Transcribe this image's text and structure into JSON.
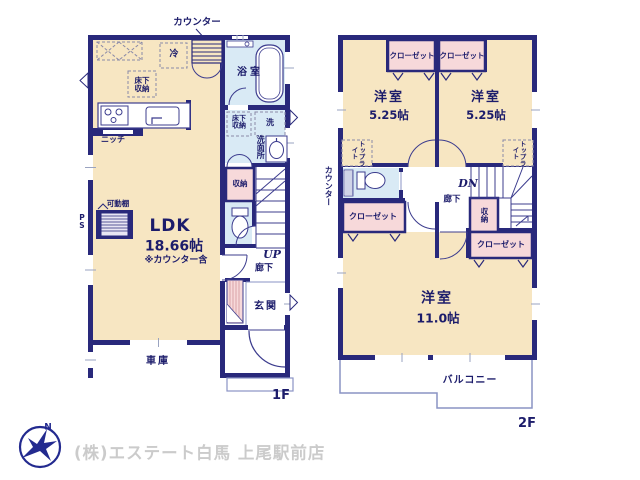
{
  "colors": {
    "wall": "#29297b",
    "room_beige": "#f7e6c2",
    "room_blue": "#d9eaf5",
    "room_pink": "#f7d9da",
    "thin_outline": "#8a93c4",
    "text": "#1c1c6b",
    "company_text": "#cbcbcb"
  },
  "floor1": {
    "label": "1F",
    "counter_label": "カウンター",
    "ldk": {
      "name": "LDK",
      "size": "18.66帖",
      "note": "※カウンター含"
    },
    "kitchen": {
      "fridge": "冷",
      "underfloor_storage": "床下収納",
      "niche": "ニッチ"
    },
    "bathroom": {
      "name": "浴室"
    },
    "washroom": {
      "name": "洗面所",
      "underfloor_storage": "床下収納",
      "laundry": "洗"
    },
    "storage": "収納",
    "movable_shelf": "可動棚",
    "pipe_space": "PS",
    "stairs": "UP",
    "hallway": "廊下",
    "entrance": "玄関",
    "garage": "車庫"
  },
  "floor2": {
    "label": "2F",
    "counter_label": "カウンター",
    "bedroom_left": {
      "name": "洋室",
      "size": "5.25帖",
      "closet": "クローゼット",
      "skylight": "トップライト"
    },
    "bedroom_right": {
      "name": "洋室",
      "size": "5.25帖",
      "closet": "クローゼット",
      "skylight": "トップライト"
    },
    "bedroom_main": {
      "name": "洋室",
      "size": "11.0帖",
      "closet_left": "クローゼット",
      "closet_right": "クローゼット",
      "storage": "収納"
    },
    "hallway": "廊下",
    "stairs": "DN",
    "balcony": "バルコニー"
  },
  "footer": {
    "company": "(株)エステート白馬 上尾駅前店",
    "logo_letter": "N"
  }
}
